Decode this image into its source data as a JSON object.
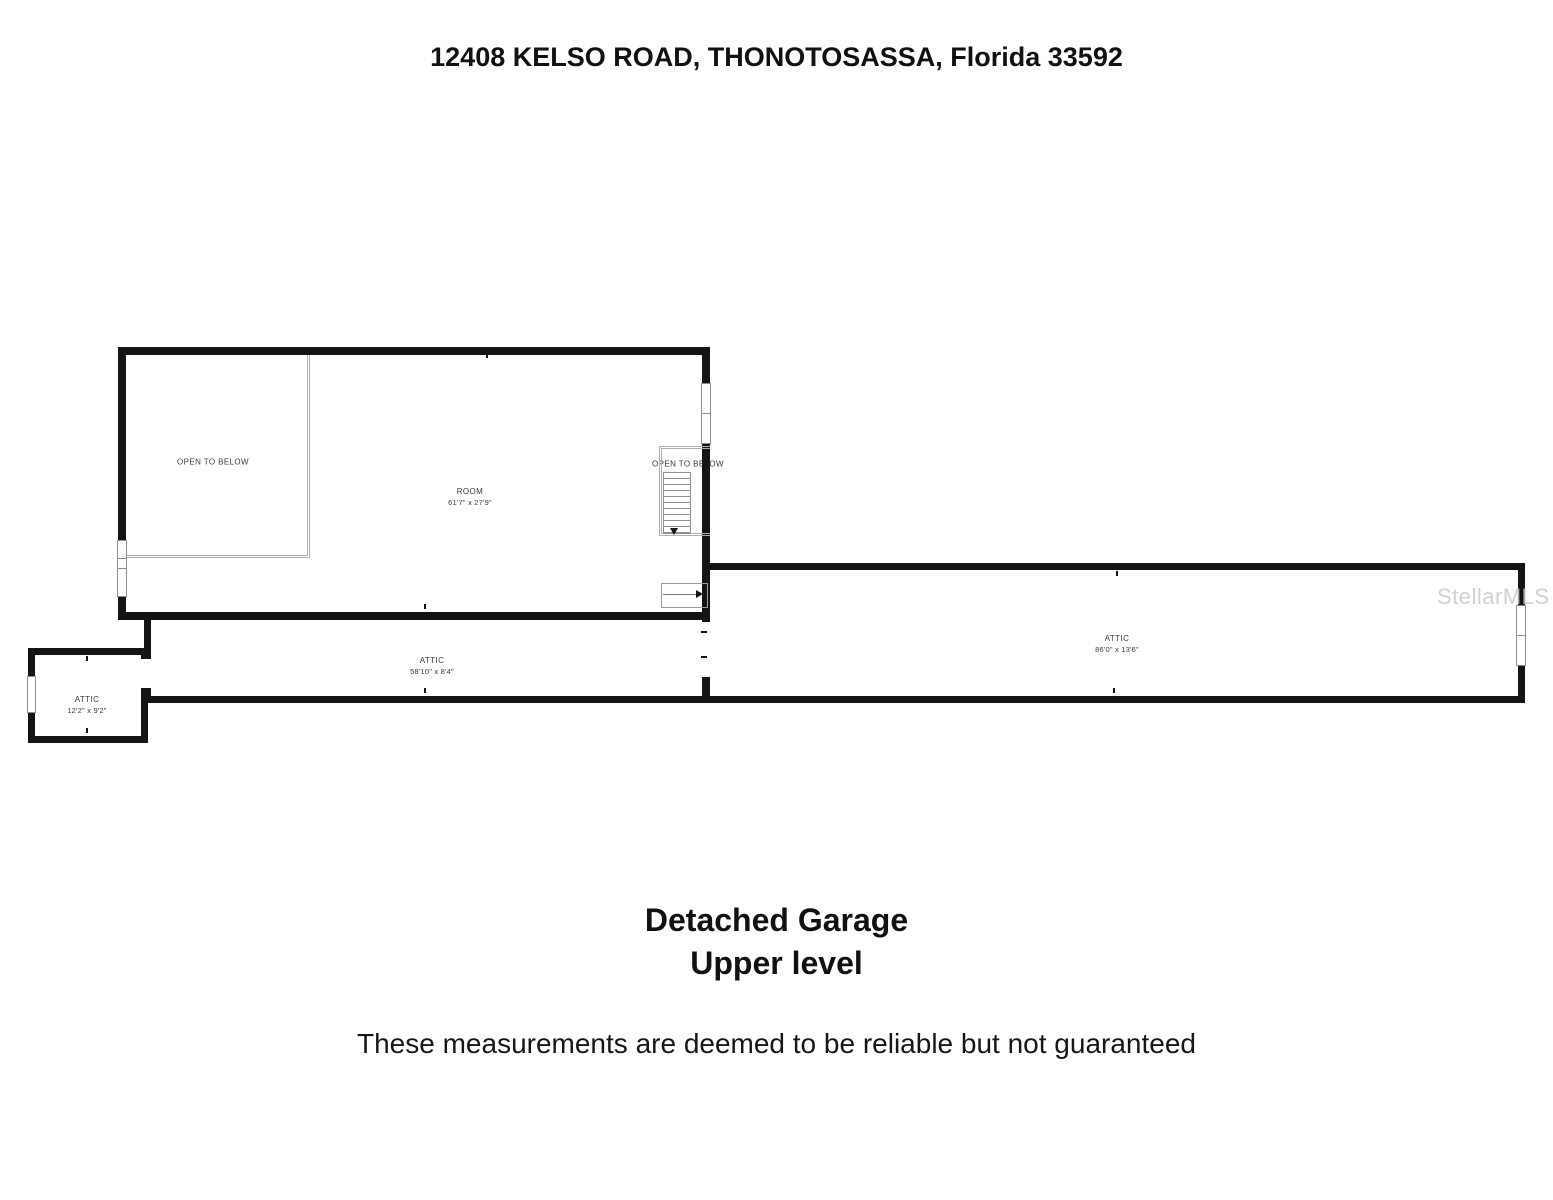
{
  "page": {
    "title": "12408 KELSO ROAD, THONOTOSASSA, Florida 33592"
  },
  "floorplan": {
    "colors": {
      "wall": "#141414",
      "thin_line": "#b0b0b0",
      "label": "#3a3a3a",
      "watermark": "#c8c8c8"
    },
    "watermark": "StellarMLS",
    "main_room": {
      "name": "ROOM",
      "dims": "61'7\" x 27'9\""
    },
    "open_to_below_left": "OPEN TO BELOW",
    "open_to_below_stairs": "OPEN TO BELOW",
    "attic_long": {
      "name": "ATTIC",
      "dims": "58'10\" x 8'4\""
    },
    "attic_wide": {
      "name": "ATTIC",
      "dims": "86'0\" x 13'6\""
    },
    "attic_small": {
      "name": "ATTIC",
      "dims": "12'2\" x 9'2\""
    }
  },
  "caption": {
    "line1": "Detached Garage",
    "line2": "Upper level"
  },
  "disclaimer": "These measurements are deemed to be reliable but not guaranteed"
}
